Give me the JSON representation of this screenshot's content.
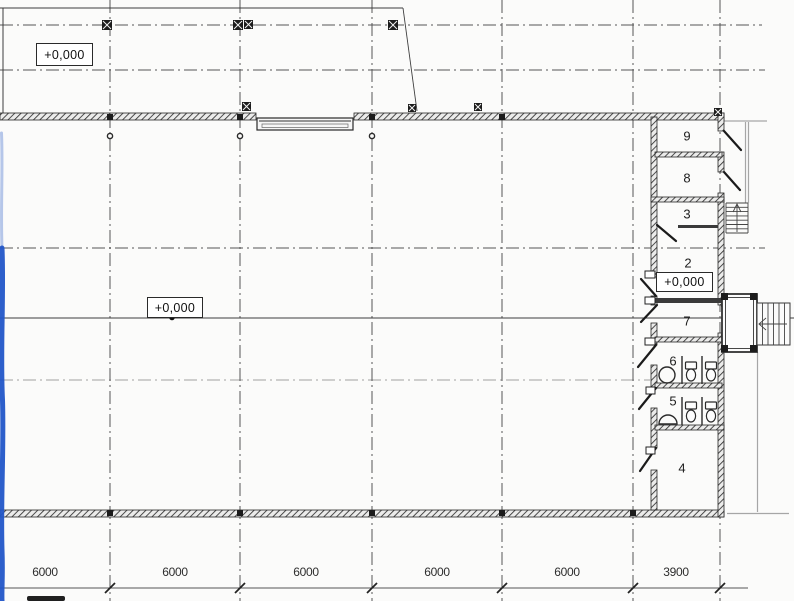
{
  "drawing_type": "floor-plan",
  "rooms": [
    {
      "number": "9"
    },
    {
      "number": "8"
    },
    {
      "number": "3"
    },
    {
      "number": "2"
    },
    {
      "number": "7"
    },
    {
      "number": "6"
    },
    {
      "number": "5"
    },
    {
      "number": "4"
    }
  ],
  "elevations": [
    {
      "label": "+0,000"
    },
    {
      "label": "+0,000"
    },
    {
      "label": "+0,000"
    }
  ],
  "dimensions": {
    "segments": [
      {
        "label": "6000"
      },
      {
        "label": "6000"
      },
      {
        "label": "6000"
      },
      {
        "label": "6000"
      },
      {
        "label": "6000"
      },
      {
        "label": "3900"
      }
    ]
  },
  "icons": [
    {
      "name": "toilet-icon"
    },
    {
      "name": "sink-icon"
    },
    {
      "name": "stairs-up-icon"
    },
    {
      "name": "entrance-stairs-icon"
    }
  ],
  "colors": {
    "background": "#fbfbfa",
    "line": "#3d3d3d",
    "grid": "#555555",
    "aux": "#a6a6a6",
    "annotation_blue": "#2256c8"
  }
}
